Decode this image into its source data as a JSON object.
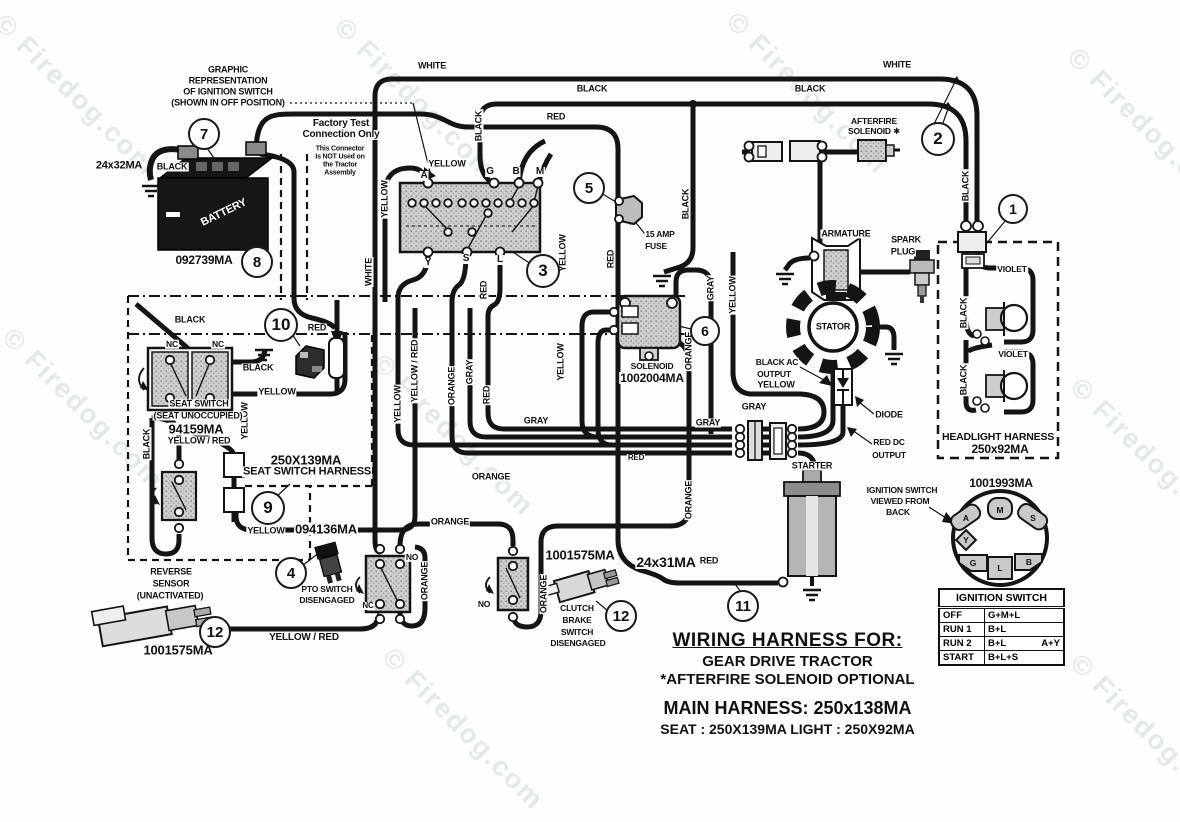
{
  "watermark": {
    "text": "© Firedog.com"
  },
  "watermark_positions": [
    {
      "x": 10,
      "y": 8
    },
    {
      "x": 350,
      "y": 12
    },
    {
      "x": 742,
      "y": 6
    },
    {
      "x": 1083,
      "y": 42
    },
    {
      "x": 18,
      "y": 322
    },
    {
      "x": 388,
      "y": 348
    },
    {
      "x": 1086,
      "y": 372
    },
    {
      "x": 398,
      "y": 642
    },
    {
      "x": 1086,
      "y": 648
    }
  ],
  "colors": {
    "ink": "#141414",
    "stipple": "#c9c9c9",
    "paper": "#fdfdfd"
  },
  "callouts": [
    {
      "n": "1",
      "x": 1013,
      "y": 209,
      "r": 13
    },
    {
      "n": "2",
      "x": 938,
      "y": 139,
      "r": 15
    },
    {
      "n": "3",
      "x": 543,
      "y": 271,
      "r": 15
    },
    {
      "n": "4",
      "x": 291,
      "y": 573,
      "r": 14
    },
    {
      "n": "5",
      "x": 589,
      "y": 188,
      "r": 14
    },
    {
      "n": "6",
      "x": 705,
      "y": 331,
      "r": 13
    },
    {
      "n": "7",
      "x": 204,
      "y": 134,
      "r": 14
    },
    {
      "n": "8",
      "x": 257,
      "y": 262,
      "r": 14
    },
    {
      "n": "9",
      "x": 268,
      "y": 508,
      "r": 15
    },
    {
      "n": "10",
      "x": 281,
      "y": 325,
      "r": 15
    },
    {
      "n": "11",
      "x": 743,
      "y": 606,
      "r": 14
    },
    {
      "n": "12",
      "x": 621,
      "y": 616,
      "r": 14
    },
    {
      "n": "12",
      "x": 215,
      "y": 632,
      "r": 14
    }
  ],
  "labels": [
    {
      "n": "graphic-note-1",
      "t": "GRAPHIC",
      "x": 228,
      "y": 70
    },
    {
      "n": "graphic-note-2",
      "t": "REPRESENTATION",
      "x": 228,
      "y": 81
    },
    {
      "n": "graphic-note-3",
      "t": "OF IGNITION SWITCH",
      "x": 228,
      "y": 92
    },
    {
      "n": "graphic-note-4",
      "t": "(SHOWN IN OFF POSITION)",
      "x": 228,
      "y": 103
    },
    {
      "n": "factory-test-1",
      "t": "Factory Test",
      "x": 341,
      "y": 124,
      "s": 10
    },
    {
      "n": "factory-test-2",
      "t": "Connection Only",
      "x": 341,
      "y": 135,
      "s": 10
    },
    {
      "n": "factory-test-3",
      "t": "This Connector",
      "x": 340,
      "y": 149,
      "s": 7
    },
    {
      "n": "factory-test-4",
      "t": "Is NOT Used on",
      "x": 340,
      "y": 157,
      "s": 7
    },
    {
      "n": "factory-test-5",
      "t": "the Tractor",
      "x": 340,
      "y": 165,
      "s": 7
    },
    {
      "n": "factory-test-6",
      "t": "Assembly",
      "x": 340,
      "y": 173,
      "s": 7
    },
    {
      "n": "battery-gauge",
      "t": "24x32MA",
      "x": 119,
      "y": 166,
      "s": 11
    },
    {
      "n": "battery-wire-black",
      "t": "BLACK",
      "x": 172,
      "y": 167
    },
    {
      "n": "battery-part",
      "t": "092739MA",
      "x": 204,
      "y": 260,
      "s": 12
    },
    {
      "n": "battery-name",
      "t": "BATTERY",
      "x": 224,
      "y": 213,
      "r": -26,
      "c": "#fff",
      "s": 11
    },
    {
      "n": "wire-white-top-left",
      "t": "WHITE",
      "x": 432,
      "y": 66
    },
    {
      "n": "wire-black-top-left",
      "t": "BLACK",
      "x": 592,
      "y": 89
    },
    {
      "n": "wire-red-top",
      "t": "RED",
      "x": 556,
      "y": 117
    },
    {
      "n": "wire-black-top-right",
      "t": "BLACK",
      "x": 810,
      "y": 89
    },
    {
      "n": "wire-white-top-right",
      "t": "WHITE",
      "x": 897,
      "y": 65
    },
    {
      "n": "afterfire-1",
      "t": "AFTERFIRE",
      "x": 874,
      "y": 121,
      "s": 8.5
    },
    {
      "n": "afterfire-2",
      "t": "SOLENOID ✱",
      "x": 874,
      "y": 131,
      "s": 8.5
    },
    {
      "n": "wire-yellow-switch",
      "t": "YELLOW",
      "x": 447,
      "y": 164
    },
    {
      "n": "term-a",
      "t": "A",
      "x": 424,
      "y": 176,
      "s": 10
    },
    {
      "n": "term-g",
      "t": "G",
      "x": 490,
      "y": 172,
      "s": 10
    },
    {
      "n": "term-b",
      "t": "B",
      "x": 516,
      "y": 172,
      "s": 10
    },
    {
      "n": "term-m",
      "t": "M",
      "x": 540,
      "y": 172,
      "s": 10
    },
    {
      "n": "term-y",
      "t": "Y",
      "x": 428,
      "y": 263,
      "s": 10
    },
    {
      "n": "term-s",
      "t": "S",
      "x": 466,
      "y": 259,
      "s": 10
    },
    {
      "n": "term-l",
      "t": "L",
      "x": 500,
      "y": 260,
      "s": 10
    },
    {
      "n": "fuse-1",
      "t": "15 AMP",
      "x": 660,
      "y": 234,
      "s": 8.5
    },
    {
      "n": "fuse-2",
      "t": "FUSE",
      "x": 656,
      "y": 246,
      "s": 8.5
    },
    {
      "n": "v-yellow-a",
      "t": "YELLOW",
      "x": 385,
      "y": 199,
      "r": -90
    },
    {
      "n": "v-white",
      "t": "WHITE",
      "x": 369,
      "y": 272,
      "r": -90
    },
    {
      "n": "v-black-g",
      "t": "BLACK",
      "x": 479,
      "y": 126,
      "r": -90
    },
    {
      "n": "v-yellow-l",
      "t": "YELLOW",
      "x": 563,
      "y": 253,
      "r": -90
    },
    {
      "n": "v-red-l",
      "t": "RED",
      "x": 484,
      "y": 290,
      "r": -90
    },
    {
      "n": "v-red-fuse",
      "t": "RED",
      "x": 611,
      "y": 259,
      "r": -90
    },
    {
      "n": "v-black-gnd",
      "t": "BLACK",
      "x": 686,
      "y": 204,
      "r": -90
    },
    {
      "n": "v-black-right",
      "t": "BLACK",
      "x": 966,
      "y": 186,
      "r": -90
    },
    {
      "n": "v-yellow-band",
      "t": "YELLOW",
      "x": 398,
      "y": 404,
      "r": -90
    },
    {
      "n": "v-yellowred-band",
      "t": "YELLOW / RED",
      "x": 415,
      "y": 371,
      "r": -90
    },
    {
      "n": "v-orange-band",
      "t": "ORANGE",
      "x": 452,
      "y": 386,
      "r": -90
    },
    {
      "n": "v-gray-band",
      "t": "GRAY",
      "x": 470,
      "y": 372,
      "r": -90
    },
    {
      "n": "v-red-band",
      "t": "RED",
      "x": 487,
      "y": 395,
      "r": -90
    },
    {
      "n": "v-yellow-sol",
      "t": "YELLOW",
      "x": 561,
      "y": 362,
      "r": -90
    },
    {
      "n": "v-gray-stator",
      "t": "GRAY",
      "x": 711,
      "y": 288,
      "r": -90
    },
    {
      "n": "v-yellow-stator",
      "t": "YELLOW",
      "x": 733,
      "y": 295,
      "r": -90
    },
    {
      "n": "v-orange-sol",
      "t": "ORANGE",
      "x": 689,
      "y": 351,
      "r": -90
    },
    {
      "n": "v-orange-low",
      "t": "ORANGE",
      "x": 689,
      "y": 500,
      "r": -90
    },
    {
      "n": "v-orange-pto",
      "t": "ORANGE",
      "x": 425,
      "y": 581,
      "r": -90
    },
    {
      "n": "v-orange-clutch",
      "t": "ORANGE",
      "x": 544,
      "y": 594,
      "r": -90
    },
    {
      "n": "v-yellow-seat",
      "t": "YELLOW",
      "x": 245,
      "y": 421,
      "r": -90
    },
    {
      "n": "v-black-rev",
      "t": "BLACK",
      "x": 147,
      "y": 444,
      "r": -90
    },
    {
      "n": "v-black-hl1",
      "t": "BLACK",
      "x": 964,
      "y": 313,
      "r": -90
    },
    {
      "n": "v-black-hl2",
      "t": "BLACK",
      "x": 964,
      "y": 380,
      "r": -90
    },
    {
      "n": "armature-name",
      "t": "ARMATURE",
      "x": 846,
      "y": 234
    },
    {
      "n": "spark-1",
      "t": "SPARK",
      "x": 906,
      "y": 240
    },
    {
      "n": "spark-2",
      "t": "PLUG",
      "x": 903,
      "y": 252
    },
    {
      "n": "stator-name",
      "t": "STATOR",
      "x": 833,
      "y": 327
    },
    {
      "n": "blackac-1",
      "t": "BLACK AC",
      "x": 777,
      "y": 362,
      "s": 8.5
    },
    {
      "n": "blackac-2",
      "t": "OUTPUT",
      "x": 774,
      "y": 374,
      "s": 8.5
    },
    {
      "n": "wire-yellow-ac",
      "t": "YELLOW",
      "x": 776,
      "y": 385
    },
    {
      "n": "wire-gray-1",
      "t": "GRAY",
      "x": 754,
      "y": 407
    },
    {
      "n": "wire-gray-2",
      "t": "GRAY",
      "x": 708,
      "y": 423
    },
    {
      "n": "diode-name",
      "t": "DIODE",
      "x": 889,
      "y": 415
    },
    {
      "n": "reddc-1",
      "t": "RED DC",
      "x": 889,
      "y": 442,
      "s": 8.5
    },
    {
      "n": "reddc-2",
      "t": "OUTPUT",
      "x": 889,
      "y": 455,
      "s": 8.5
    },
    {
      "n": "starter-name",
      "t": "STARTER",
      "x": 812,
      "y": 466
    },
    {
      "n": "wire-gray-3",
      "t": "GRAY",
      "x": 536,
      "y": 421
    },
    {
      "n": "wire-orange-1",
      "t": "ORANGE",
      "x": 491,
      "y": 477
    },
    {
      "n": "wire-orange-2",
      "t": "ORANGE",
      "x": 450,
      "y": 522
    },
    {
      "n": "wire-red-bundle",
      "t": "RED",
      "x": 636,
      "y": 458,
      "s": 8
    },
    {
      "n": "solenoid-name",
      "t": "SOLENOID",
      "x": 652,
      "y": 366,
      "s": 8.5
    },
    {
      "n": "solenoid-part",
      "t": "1002004MA",
      "x": 652,
      "y": 378,
      "s": 12
    },
    {
      "n": "seat-black-top",
      "t": "BLACK",
      "x": 190,
      "y": 320
    },
    {
      "n": "seat-nc-1",
      "t": "NC",
      "x": 172,
      "y": 344,
      "s": 8.5
    },
    {
      "n": "seat-nc-2",
      "t": "NC",
      "x": 218,
      "y": 344,
      "s": 8.5
    },
    {
      "n": "seat-black-right",
      "t": "BLACK",
      "x": 258,
      "y": 368
    },
    {
      "n": "seat-red",
      "t": "RED",
      "x": 317,
      "y": 328
    },
    {
      "n": "seat-yellow",
      "t": "YELLOW",
      "x": 277,
      "y": 392
    },
    {
      "n": "seat-name-1",
      "t": "SEAT SWITCH",
      "x": 199,
      "y": 404
    },
    {
      "n": "seat-name-2",
      "t": "(SEAT UNOCCUPIED)",
      "x": 198,
      "y": 416
    },
    {
      "n": "seat-part",
      "t": "94159MA",
      "x": 196,
      "y": 429,
      "s": 13
    },
    {
      "n": "seat-yellowred",
      "t": "YELLOW / RED",
      "x": 199,
      "y": 441
    },
    {
      "n": "harness-part",
      "t": "250X139MA",
      "x": 306,
      "y": 460,
      "s": 13
    },
    {
      "n": "harness-name",
      "t": "SEAT SWITCH HARNESS",
      "x": 307,
      "y": 472,
      "s": 11
    },
    {
      "n": "wire-yellow-low",
      "t": "YELLOW",
      "x": 266,
      "y": 531
    },
    {
      "n": "pto-conn-part",
      "t": "094136MA",
      "x": 326,
      "y": 529,
      "s": 13
    },
    {
      "n": "pto-name-1",
      "t": "PTO SWITCH",
      "x": 327,
      "y": 589,
      "s": 8.5
    },
    {
      "n": "pto-name-2",
      "t": "DISENGAGED",
      "x": 327,
      "y": 600,
      "s": 8.5
    },
    {
      "n": "pto-nc",
      "t": "NC",
      "x": 368,
      "y": 606,
      "s": 8
    },
    {
      "n": "pto-no",
      "t": "NO",
      "x": 412,
      "y": 557,
      "s": 8.5
    },
    {
      "n": "clutch-no",
      "t": "NO",
      "x": 484,
      "y": 604,
      "s": 8.5
    },
    {
      "n": "clutch-name-1",
      "t": "CLUTCH",
      "x": 577,
      "y": 608,
      "s": 8.5
    },
    {
      "n": "clutch-name-2",
      "t": "BRAKE",
      "x": 577,
      "y": 620,
      "s": 8.5
    },
    {
      "n": "clutch-name-3",
      "t": "SWITCH",
      "x": 577,
      "y": 632,
      "s": 8.5
    },
    {
      "n": "clutch-name-4",
      "t": "DISENGAGED",
      "x": 578,
      "y": 643,
      "s": 8.5
    },
    {
      "n": "clutch-part",
      "t": "1001575MA",
      "x": 580,
      "y": 555,
      "s": 13
    },
    {
      "n": "reverse-name-1",
      "t": "REVERSE",
      "x": 171,
      "y": 572
    },
    {
      "n": "reverse-name-2",
      "t": "SENSOR",
      "x": 171,
      "y": 584
    },
    {
      "n": "reverse-name-3",
      "t": "(UNACTIVATED)",
      "x": 170,
      "y": 596
    },
    {
      "n": "reverse-part",
      "t": "1001575MA",
      "x": 178,
      "y": 650,
      "s": 13
    },
    {
      "n": "wire-yellowred-bottom",
      "t": "YELLOW / RED",
      "x": 304,
      "y": 638,
      "s": 10
    },
    {
      "n": "starter-gauge",
      "t": "24x31MA",
      "x": 666,
      "y": 562,
      "s": 14
    },
    {
      "n": "starter-red",
      "t": "RED",
      "x": 709,
      "y": 561
    },
    {
      "n": "ignsw-note-1",
      "t": "IGNITION SWITCH",
      "x": 902,
      "y": 490,
      "s": 8.5
    },
    {
      "n": "ignsw-note-2",
      "t": "VIEWED FROM",
      "x": 900,
      "y": 501,
      "s": 8.5
    },
    {
      "n": "ignsw-note-3",
      "t": "BACK",
      "x": 898,
      "y": 512,
      "s": 8.5
    },
    {
      "n": "ignsw-part",
      "t": "1001993MA",
      "x": 1001,
      "y": 483,
      "s": 12
    },
    {
      "n": "headlight-name",
      "t": "HEADLIGHT HARNESS",
      "x": 998,
      "y": 437,
      "s": 10.5
    },
    {
      "n": "headlight-part",
      "t": "250x92MA",
      "x": 1000,
      "y": 449,
      "s": 12
    },
    {
      "n": "wire-violet-1",
      "t": "VIOLET",
      "x": 1012,
      "y": 269,
      "s": 8.5
    },
    {
      "n": "wire-violet-2",
      "t": "VIOLET",
      "x": 1013,
      "y": 354,
      "s": 8.5
    }
  ],
  "title_block": {
    "line1": "WIRING HARNESS FOR:",
    "line2": "GEAR DRIVE TRACTOR",
    "line3": "*AFTERFIRE SOLENOID OPTIONAL",
    "line4": "MAIN HARNESS: 250x138MA",
    "line5": "SEAT : 250X139MA    LIGHT : 250X92MA"
  },
  "ignition_table": {
    "header": "IGNITION SWITCH",
    "rows": [
      {
        "pos": "OFF",
        "circuits": "G+M+L",
        "extra": ""
      },
      {
        "pos": "RUN 1",
        "circuits": "B+L",
        "extra": ""
      },
      {
        "pos": "RUN 2",
        "circuits": "B+L",
        "extra": "A+Y"
      },
      {
        "pos": "START",
        "circuits": "B+L+S",
        "extra": ""
      }
    ]
  },
  "switch_back": {
    "part": "1001993MA",
    "terminals": [
      {
        "label": "M",
        "x": 1000,
        "y": 510
      },
      {
        "label": "A",
        "x": 966,
        "y": 518
      },
      {
        "label": "S",
        "x": 1033,
        "y": 518
      },
      {
        "label": "Y",
        "x": 966,
        "y": 540
      },
      {
        "label": "G",
        "x": 973,
        "y": 563
      },
      {
        "label": "L",
        "x": 1000,
        "y": 568
      },
      {
        "label": "B",
        "x": 1029,
        "y": 562
      }
    ]
  }
}
